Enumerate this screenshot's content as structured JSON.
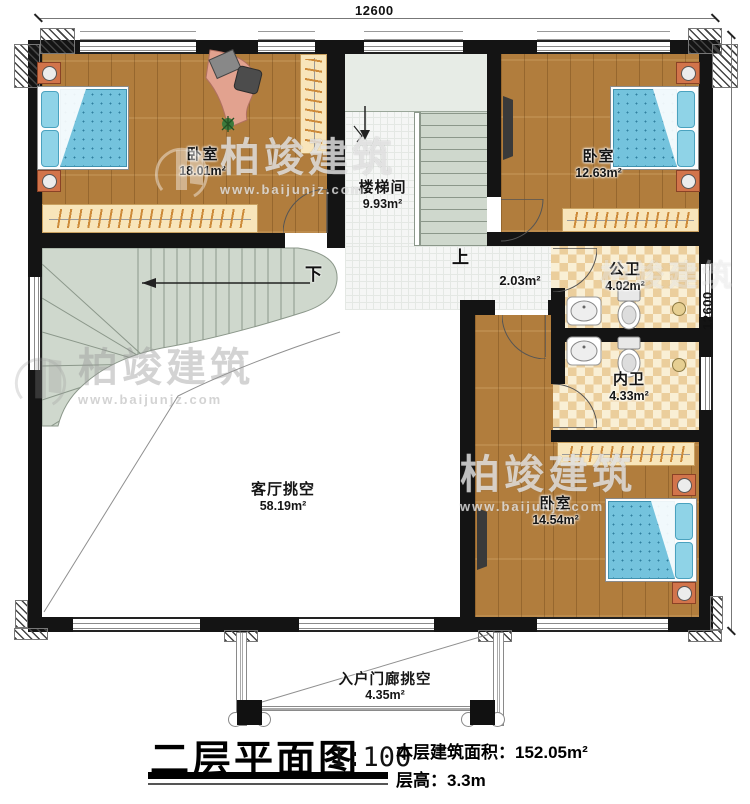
{
  "plan": {
    "dim_top": "12600",
    "dim_right": "12600",
    "rooms": {
      "bedroom1": {
        "name": "卧室",
        "area": "18.01m²"
      },
      "stairwell": {
        "name": "楼梯间",
        "area": "9.93m²"
      },
      "bedroom2": {
        "name": "卧室",
        "area": "12.63m²"
      },
      "public_bath": {
        "name": "公卫",
        "area": "4.02m²"
      },
      "private_bath": {
        "name": "内卫",
        "area": "4.33m²"
      },
      "bedroom3": {
        "name": "卧室",
        "area": "14.54m²"
      },
      "living_void": {
        "name": "客厅挑空",
        "area": "58.19m²"
      },
      "porch_void": {
        "name": "入户门廊挑空",
        "area": "4.35m²"
      },
      "corridor_area": "2.03m²"
    },
    "stairs": {
      "up": "上",
      "down": "下"
    }
  },
  "title_block": {
    "title": "二层平面图",
    "scale": "1:100",
    "area_label": "本层建筑面积：",
    "area_value": "152.05m²",
    "height_label": "层高：",
    "height_value": "3.3m"
  },
  "watermark": {
    "brand": "柏竣建筑",
    "url": "www.baijunjz.com"
  }
}
